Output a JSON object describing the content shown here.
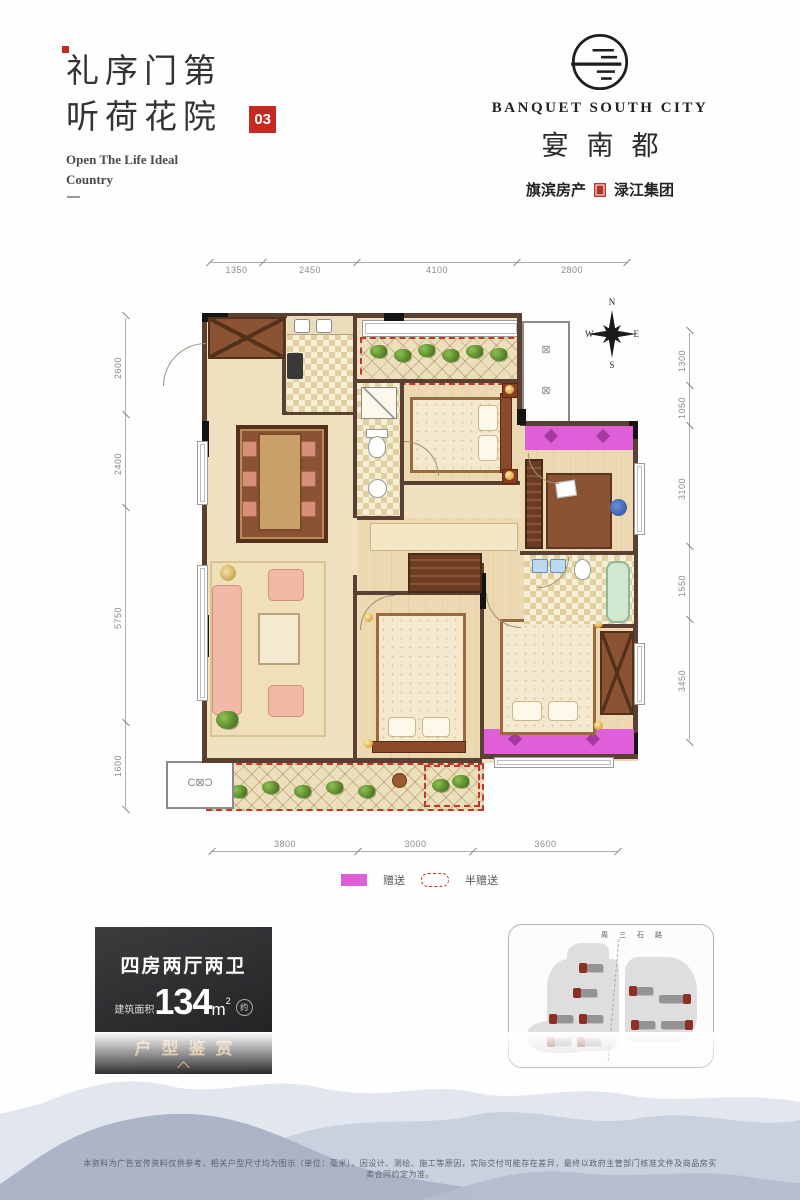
{
  "header": {
    "title_line1": "礼序门第",
    "title_line2": "听荷花院",
    "unit_badge": "03",
    "subtitle_line1": "Open The Life Ideal",
    "subtitle_line2": "Country"
  },
  "brand": {
    "logo_en": "BANQUET SOUTH CITY",
    "logo_cn": "宴南都",
    "developer_left": "旗滨房产",
    "developer_right": "渌江集团"
  },
  "compass": {
    "n": "N",
    "s": "S",
    "e": "E",
    "w": "W"
  },
  "plan": {
    "dims_top": [
      "1350",
      "2450",
      "4100",
      "2800"
    ],
    "dims_left": [
      "2600",
      "2400",
      "5750",
      "1600"
    ],
    "dims_right": [
      "1300",
      "1050",
      "3100",
      "1550",
      "3450"
    ],
    "dims_bottom": [
      "3800",
      "3000",
      "3600"
    ],
    "ac_icon": "⊠",
    "equip_icon": "C⊠Ɔ"
  },
  "legend": {
    "gift_label": "赠送",
    "half_gift_label": "半赠送"
  },
  "info_box": {
    "layout": "四房两厅两卫",
    "area_prefix": "建筑面积",
    "area_value": "134",
    "area_unit": "m",
    "area_sup": "2",
    "area_approx": "约",
    "cta": "户型鉴赏"
  },
  "site_map": {
    "road_label": "周三石路"
  },
  "footer": {
    "disclaimer": "本资料为广告宣传资料仅供参考，相关户型尺寸均为图示（单位：毫米），因设计、测绘、施工等原因，实际交付可能存在差异，最终以政府主管部门核准文件及商品房买卖合同约定为准。"
  },
  "colors": {
    "accent_red": "#c5291f",
    "gift_magenta": "#df5fd8",
    "half_gift_red": "#c0392b",
    "wall_brown": "#5a4033",
    "gold": "#c79a62"
  }
}
